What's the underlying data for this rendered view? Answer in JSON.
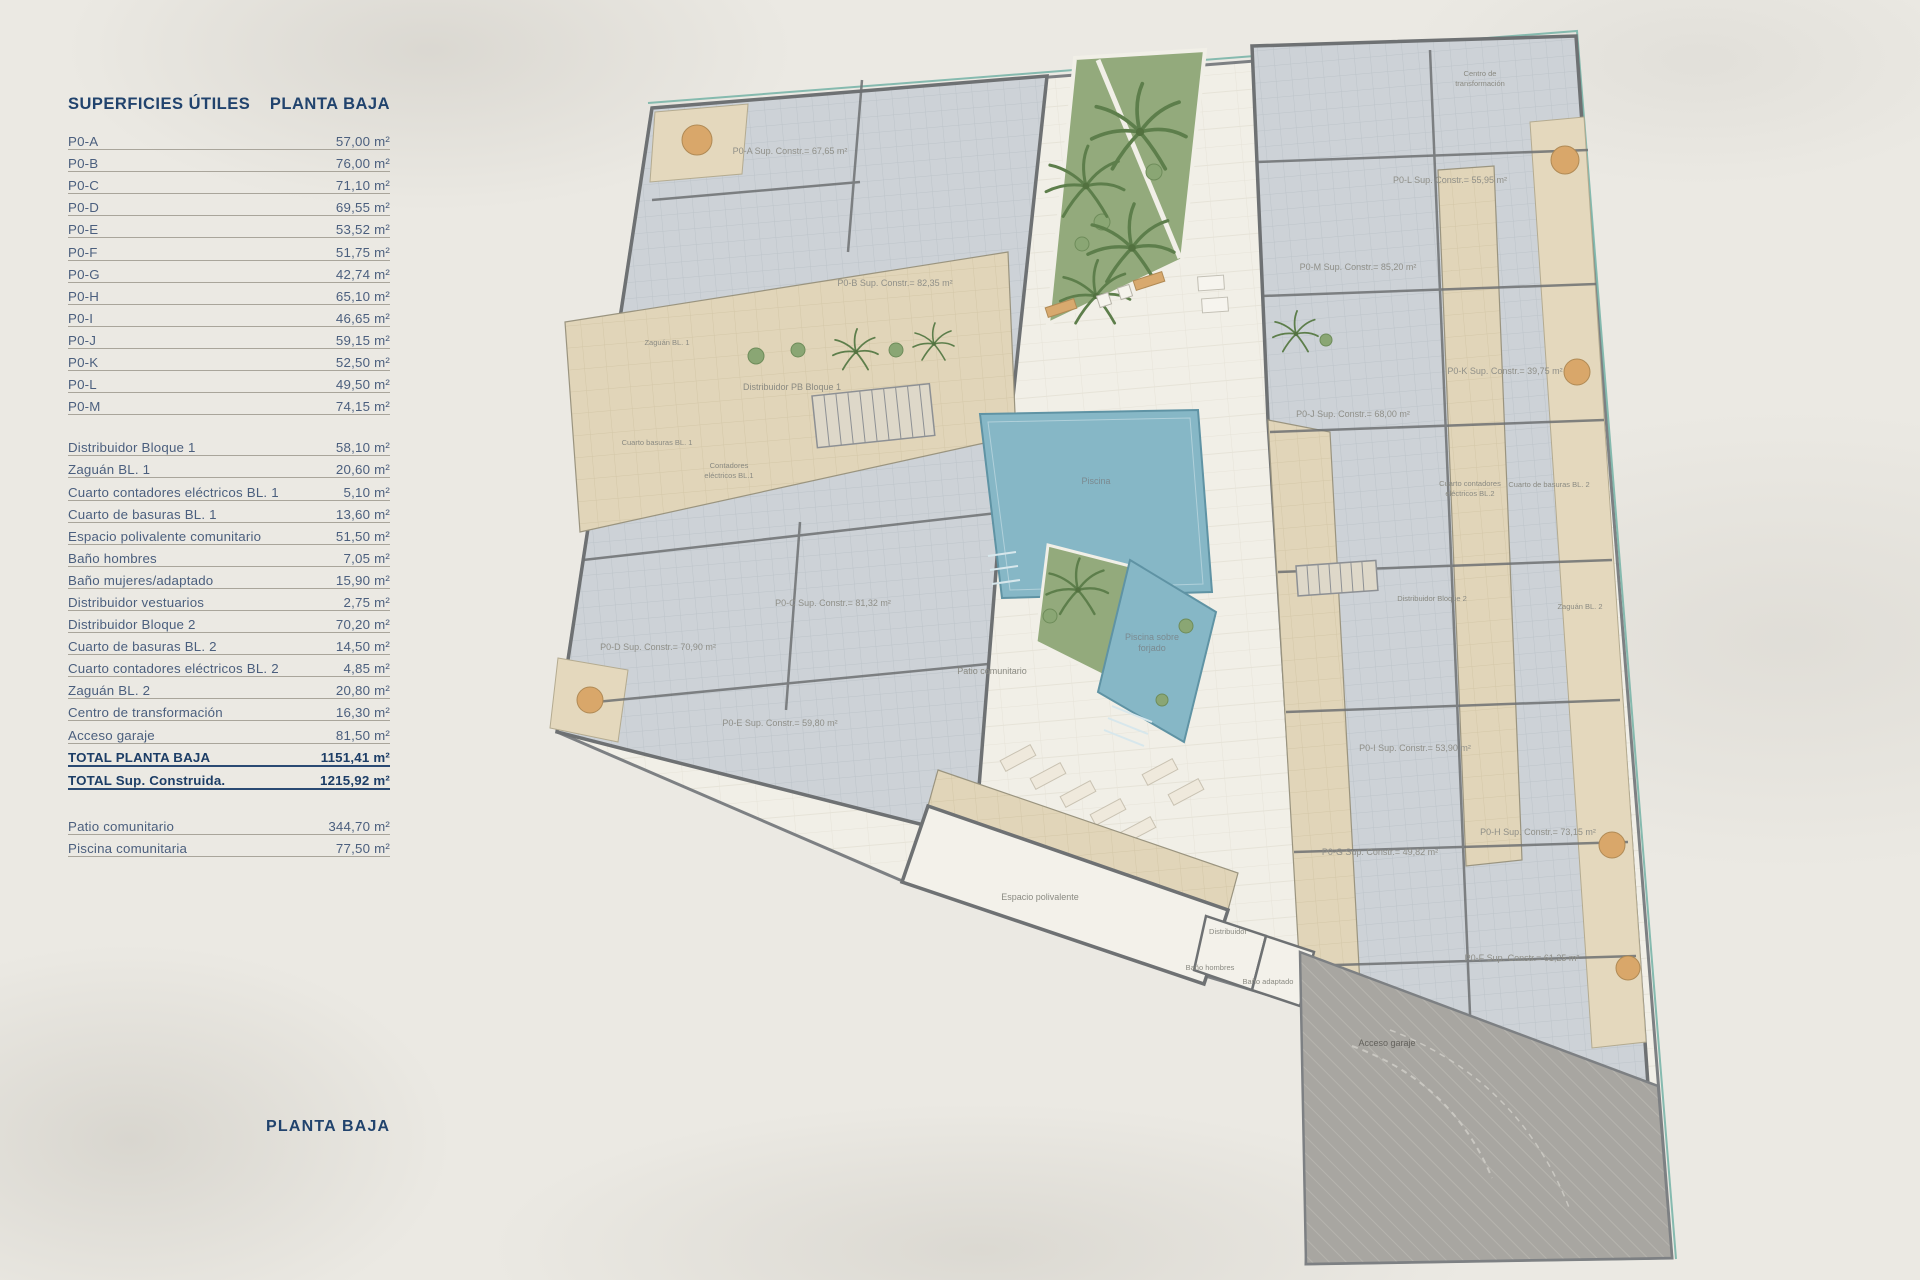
{
  "panel": {
    "title_left": "SUPERFICIES ÚTILES",
    "title_right": "PLANTA BAJA",
    "units": [
      {
        "label": "P0-A",
        "value": "57,00 m²"
      },
      {
        "label": "P0-B",
        "value": "76,00 m²"
      },
      {
        "label": "P0-C",
        "value": "71,10 m²"
      },
      {
        "label": "P0-D",
        "value": "69,55 m²"
      },
      {
        "label": "P0-E",
        "value": "53,52 m²"
      },
      {
        "label": "P0-F",
        "value": "51,75 m²"
      },
      {
        "label": "P0-G",
        "value": "42,74 m²"
      },
      {
        "label": "P0-H",
        "value": "65,10 m²"
      },
      {
        "label": "P0-I",
        "value": "46,65 m²"
      },
      {
        "label": "P0-J",
        "value": "59,15 m²"
      },
      {
        "label": "P0-K",
        "value": "52,50 m²"
      },
      {
        "label": "P0-L",
        "value": "49,50 m²"
      },
      {
        "label": "P0-M",
        "value": "74,15 m²"
      }
    ],
    "commons": [
      {
        "label": "Distribuidor Bloque 1",
        "value": "58,10 m²"
      },
      {
        "label": "Zaguán BL. 1",
        "value": "20,60 m²"
      },
      {
        "label": "Cuarto contadores eléctricos BL. 1",
        "value": "5,10 m²"
      },
      {
        "label": "Cuarto de basuras BL. 1",
        "value": "13,60 m²"
      },
      {
        "label": "Espacio polivalente comunitario",
        "value": "51,50 m²"
      },
      {
        "label": "Baño hombres",
        "value": "7,05 m²"
      },
      {
        "label": "Baño mujeres/adaptado",
        "value": "15,90 m²"
      },
      {
        "label": "Distribuidor vestuarios",
        "value": "2,75 m²"
      },
      {
        "label": "Distribuidor Bloque 2",
        "value": "70,20 m²"
      },
      {
        "label": "Cuarto de basuras BL. 2",
        "value": "14,50 m²"
      },
      {
        "label": "Cuarto contadores eléctricos BL. 2",
        "value": "4,85 m²"
      },
      {
        "label": "Zaguán BL. 2",
        "value": "20,80 m²"
      },
      {
        "label": "Centro de transformación",
        "value": "16,30 m²"
      },
      {
        "label": "Acceso garaje",
        "value": "81,50 m²"
      }
    ],
    "totals": [
      {
        "label": "TOTAL PLANTA BAJA",
        "value": "1151,41 m²"
      },
      {
        "label": "TOTAL Sup. Construida.",
        "value": "1215,92 m²"
      }
    ],
    "extras": [
      {
        "label": "Patio comunitario",
        "value": "344,70 m²"
      },
      {
        "label": "Piscina comunitaria",
        "value": "77,50 m²"
      }
    ]
  },
  "footer": {
    "title": "PLANTA BAJA"
  },
  "plan": {
    "unit_labels": [
      {
        "id": "P0-A",
        "text": "P0-A Sup. Constr.= 67,65 m²"
      },
      {
        "id": "P0-B",
        "text": "P0-B Sup. Constr.= 82,35 m²"
      },
      {
        "id": "P0-C",
        "text": "P0-C Sup. Constr.= 81,32 m²"
      },
      {
        "id": "P0-D",
        "text": "P0-D Sup. Constr.= 70,90 m²"
      },
      {
        "id": "P0-E",
        "text": "P0-E Sup. Constr.= 59,80 m²"
      },
      {
        "id": "P0-F",
        "text": "P0-F Sup. Constr.= 61,25 m²"
      },
      {
        "id": "P0-G",
        "text": "P0-G Sup. Constr.= 49,82 m²"
      },
      {
        "id": "P0-H",
        "text": "P0-H Sup. Constr.= 73,15 m²"
      },
      {
        "id": "P0-I",
        "text": "P0-I Sup. Constr.= 53,90 m²"
      },
      {
        "id": "P0-J",
        "text": "P0-J Sup. Constr.= 68,00 m²"
      },
      {
        "id": "P0-K",
        "text": "P0-K Sup. Constr.= 39,75 m²"
      },
      {
        "id": "P0-L",
        "text": "P0-L Sup. Constr.= 55,95 m²"
      },
      {
        "id": "P0-M",
        "text": "P0-M Sup. Constr.= 85,20 m²"
      }
    ],
    "room_labels": {
      "zaguan_bl1": "Zaguán BL. 1",
      "distribuidor_pb_bloque1": "Distribuidor PB Bloque 1",
      "cuarto_basuras_bl1": "Cuarto basuras BL. 1",
      "contadores_bl1": [
        "Contadores",
        "eléctricos BL.1"
      ],
      "piscina": "Piscina",
      "patio": "Patio comunitario",
      "piscina_forjado": [
        "Piscina sobre",
        "forjado"
      ],
      "distribuidor_bloque2": "Distribuidor Bloque 2",
      "zaguan_bl2": "Zaguán BL. 2",
      "basuras_bl2": "Cuarto de basuras BL. 2",
      "contadores_bl2": [
        "Cuarto contadores",
        "eléctricos BL.2"
      ],
      "centro_transformacion": [
        "Centro de",
        "transformación"
      ],
      "espacio_polivalente": "Espacio polivalente",
      "distribuidor": "Distribuidor",
      "bano_hombres": "Baño hombres",
      "bano_adaptado": "Baño adaptado",
      "acceso_garaje": "Acceso garaje"
    },
    "colors": {
      "accent_navy": "#21436d",
      "pool_blue": "#86b7c6",
      "garden_green": "#93aa7c",
      "wall_gray": "#6e7173",
      "terrace_tan": "#e1d5b9",
      "paper": "#ebe9e3"
    }
  }
}
